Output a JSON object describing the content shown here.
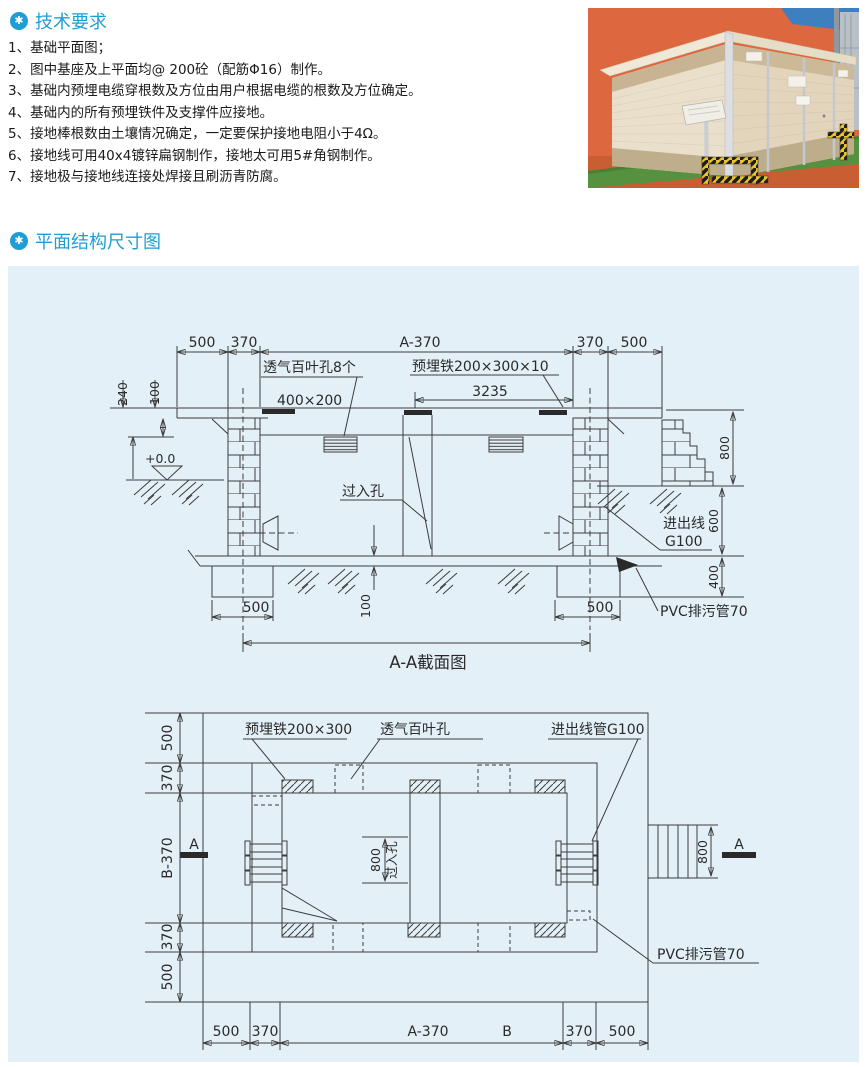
{
  "ui": {
    "header_icon": "✱"
  },
  "colors": {
    "accent": "#1f9ed6",
    "panel_bg": "#e4f0f8",
    "drawing_line": "#3c3c3c",
    "photo_wall": "#dd683f",
    "photo_grass": "#55913e",
    "photo_building": "#eadfca",
    "photo_warning": "#ecc427"
  },
  "tech": {
    "title": "技术要求",
    "items": [
      "1、基础平面图；",
      "2、图中基座及上平面均@ 200砼（配筋Φ16）制作。",
      "3、基础内预埋电缆穿根数及方位由用户根据电缆的根数及方位确定。",
      "4、基础内的所有预埋铁件及支撑件应接地。",
      "5、接地棒根数由土壤情况确定，一定要保护接地电阻小于4Ω。",
      "6、接地线可用40x4镀锌扁钢制作，接地太可用5#角钢制作。",
      "7、接地极与接地线连接处焊接且刷沥青防腐。"
    ]
  },
  "plan": {
    "title": "平面结构尺寸图"
  },
  "sv": {
    "caption": "A-A截面图",
    "louver": "透气百叶孔8个",
    "size400": "400×200",
    "embed": "预埋铁200×300×10",
    "hole": "过入孔",
    "ground": "+0.0",
    "inout": "进出线",
    "g100": "G100",
    "pvc": "PVC排污管70",
    "d500": "500",
    "d370": "370",
    "a370": "A-370",
    "d3235": "3235",
    "d240": "240",
    "d100": "100",
    "d800": "800",
    "d600": "600",
    "d400": "400"
  },
  "pv": {
    "embed": "预埋铁200×300",
    "louver": "透气百叶孔",
    "inout": "进出线管G100",
    "pvc": "PVC排污管70",
    "hole": "过入孔",
    "a": "A",
    "b": "B",
    "a370": "A-370",
    "b370": "B-370",
    "d500": "500",
    "d370": "370",
    "d800": "800"
  }
}
